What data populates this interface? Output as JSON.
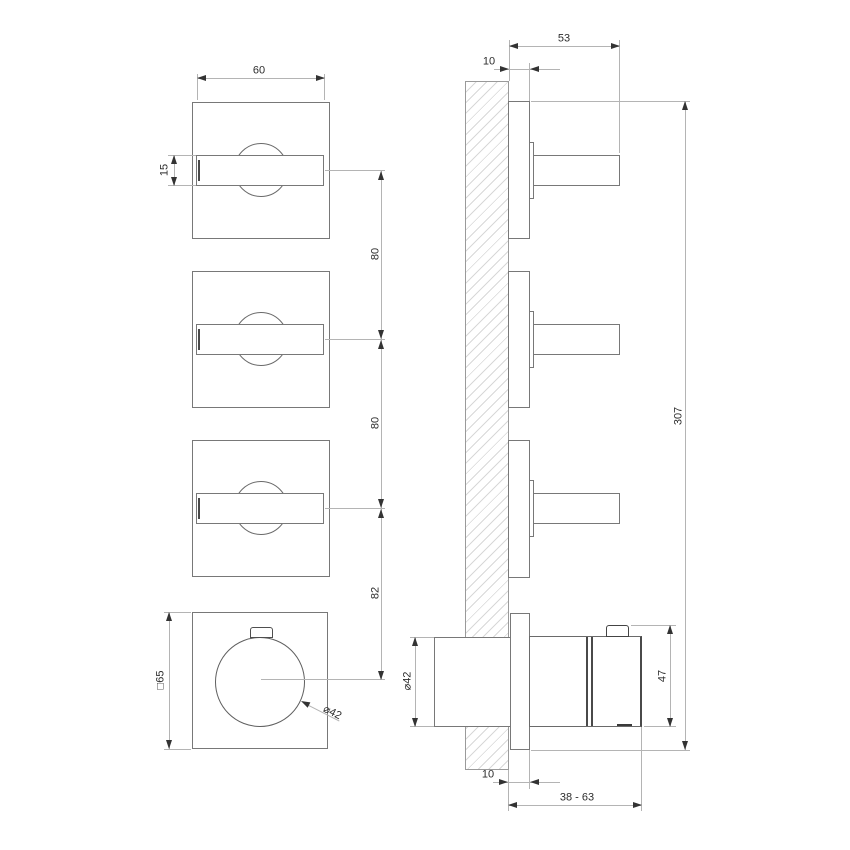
{
  "front_view": {
    "dim_lever_length": "60",
    "dim_lever_height": "15",
    "dim_pitch_1": "80",
    "dim_pitch_2": "80",
    "dim_pitch_3": "82",
    "dim_plate_square": "□65",
    "dim_knob_diameter": "⌀42"
  },
  "side_view": {
    "dim_lever_projection": "53",
    "dim_plate_offset_top": "10",
    "dim_overall_height": "307",
    "dim_body_diameter": "⌀42",
    "dim_knob_height": "47",
    "dim_plate_offset_bottom": "10",
    "dim_install_depth_range": "38 - 63"
  },
  "colors": {
    "object_line": "#787878",
    "dimension_line": "#b4b4b4",
    "text": "#2d2d2d",
    "hatch": "#d8d8d8",
    "background": "#ffffff"
  }
}
